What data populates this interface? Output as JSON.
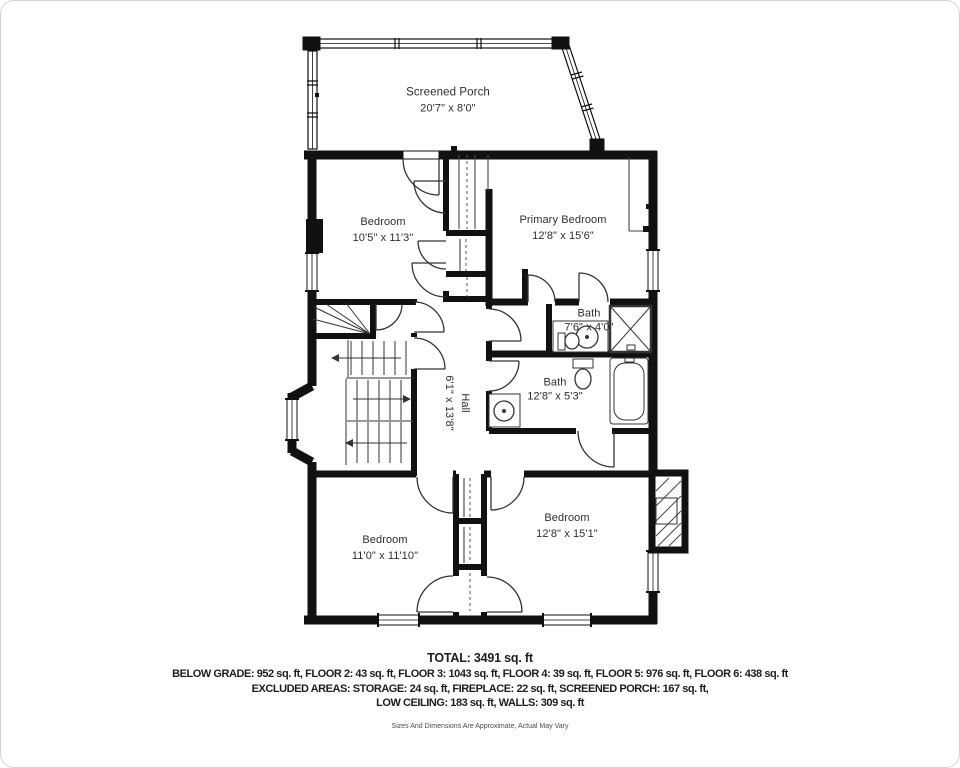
{
  "rooms": [
    {
      "id": "screened-porch",
      "name": "Screened Porch",
      "dims": "20'7\" x 8'0\""
    },
    {
      "id": "bedroom-upper-left",
      "name": "Bedroom",
      "dims": "10'5\" x 11'3\""
    },
    {
      "id": "primary-bedroom",
      "name": "Primary Bedroom",
      "dims": "12'8\" x 15'6\""
    },
    {
      "id": "bath-small",
      "name": "Bath",
      "dims": "7'6\" x 4'0\""
    },
    {
      "id": "bath-main",
      "name": "Bath",
      "dims": "12'8\" x 5'3\""
    },
    {
      "id": "hall",
      "name": "Hall",
      "dims": "6'1\" x 13'8\""
    },
    {
      "id": "bedroom-lower-left",
      "name": "Bedroom",
      "dims": "11'0\" x 11'10\""
    },
    {
      "id": "bedroom-lower-right",
      "name": "Bedroom",
      "dims": "12'8\" x 15'1\""
    }
  ],
  "summary": {
    "total": "TOTAL: 3491 sq. ft",
    "line1": "BELOW GRADE: 952 sq. ft, FLOOR 2: 43 sq. ft, FLOOR 3: 1043 sq. ft, FLOOR 4: 39 sq. ft, FLOOR 5: 976 sq. ft, FLOOR 6: 438 sq. ft",
    "line2": "EXCLUDED AREAS: STORAGE: 24 sq. ft, FIREPLACE: 22 sq. ft, SCREENED PORCH: 167 sq. ft,",
    "line3": "LOW CEILING: 183 sq. ft, WALLS: 309 sq. ft",
    "disclaimer": "Sizes And Dimensions Are Approximate, Actual May Vary"
  },
  "colors": {
    "wall": "#111111",
    "fixture": "#333333"
  }
}
